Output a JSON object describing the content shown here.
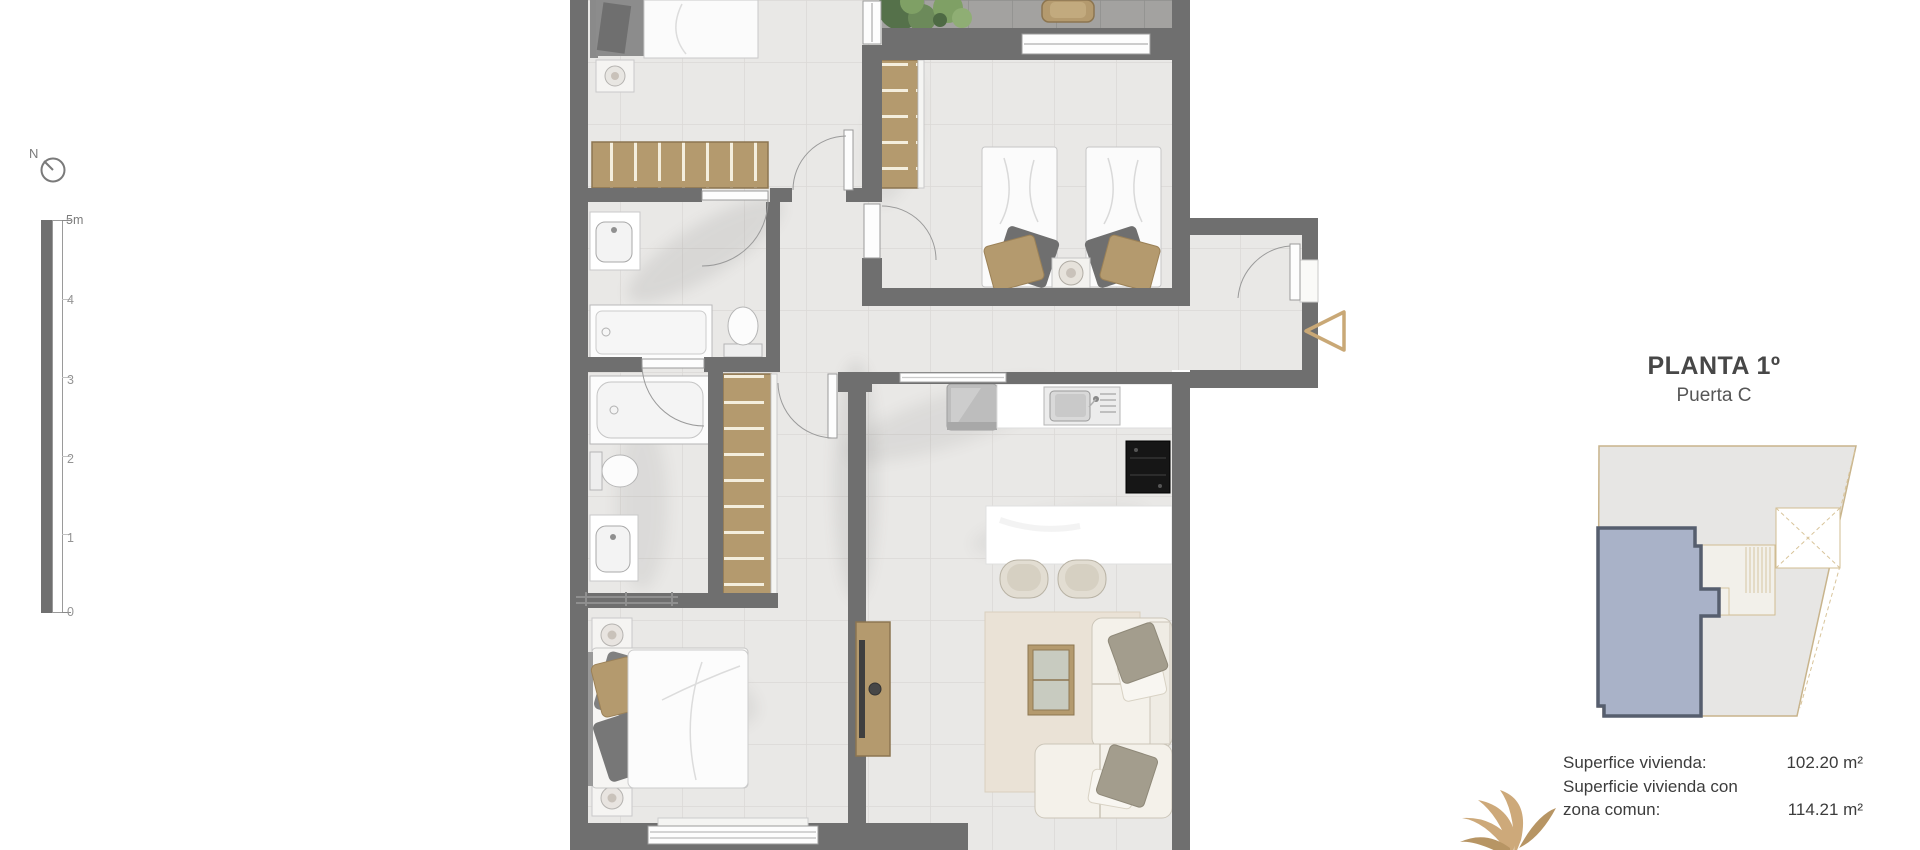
{
  "header": {
    "title": "PLANTA 1º",
    "subtitle": "Puerta C"
  },
  "areas": {
    "rows": [
      {
        "label": "Superfice vivienda:",
        "value": "102.20 m²"
      },
      {
        "label": "Superficie vivienda con",
        "value": ""
      },
      {
        "label": "zona comun:",
        "value": "114.21 m²"
      }
    ]
  },
  "scale_bar": {
    "labels": [
      "5m",
      "4",
      "3",
      "2",
      "1",
      "0"
    ]
  },
  "north": {
    "label": "N"
  },
  "colors": {
    "wall": "#6f6f6f",
    "floor": "#e9e8e6",
    "terrace_floor": "#a3a2a0",
    "wood": "#b49a6e",
    "accent_tan": "#c9a876",
    "site_unit_fill": "#a9b2c8",
    "site_unit_stroke": "#565e6e",
    "site_building_fill": "#e7e6e4",
    "site_building_stroke": "#c8b48c"
  }
}
